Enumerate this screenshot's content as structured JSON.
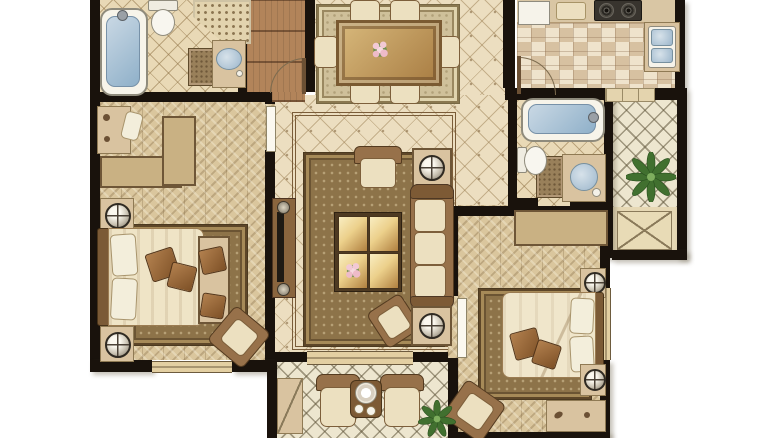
{
  "meta": {
    "kind": "residential-floor-plan-rendering",
    "visible_text": [],
    "width_px": 780,
    "height_px": 438
  },
  "palette": {
    "background": "#ffffff",
    "wall": "#19120c",
    "diamond_tile": "#ecdec0",
    "small_tile": "#e9d9b6",
    "lattice_tile": "#ede6cf",
    "herringbone_wood": "#dac69d",
    "checker_tile_a": "#d7c1a1",
    "checker_tile_b": "#efe3cc",
    "plank_wood": "#b2845a",
    "rug_brown": "#8d7349",
    "rug_light": "#cfc09a",
    "upholstery_brown": "#97714a",
    "upholstery_cream": "#ece0c0",
    "water_blue": "#9cb6cb",
    "gold_table": "#ecd08b",
    "plant_green": "#41702f"
  },
  "rooms": [
    {
      "id": "bathroom-1",
      "position": "top-left",
      "floor": "small-diamond-tile",
      "furniture": [
        "bathtub",
        "toilet",
        "washbasin-counter",
        "shower-mosaic-corner",
        "bath-mat"
      ]
    },
    {
      "id": "entry-hall",
      "position": "top-middle-left",
      "floor": "wood-planks",
      "furniture": [
        "entry-door-swing"
      ]
    },
    {
      "id": "dining-room",
      "position": "top-middle",
      "floor": "diamond-tile",
      "furniture": [
        "dining-table",
        "flower-centerpiece",
        "chair-x6",
        "area-rug"
      ]
    },
    {
      "id": "kitchen",
      "position": "top-right",
      "floor": "checker-tile",
      "furniture": [
        "refrigerator",
        "cutting-board",
        "two-burner-cooktop",
        "double-sink",
        "door-swing",
        "steps"
      ]
    },
    {
      "id": "living-room",
      "position": "center",
      "floor": "diamond-tile-with-border",
      "furniture": [
        "tv-console",
        "three-seat-sofa",
        "armchair-x2",
        "coffee-table-4-panel",
        "side-table-with-lamp-x2",
        "flower-bouquet",
        "area-rug"
      ]
    },
    {
      "id": "master-bedroom",
      "position": "left",
      "floor": "herringbone-wood",
      "furniture": [
        "double-bed",
        "pillows",
        "bed-bench",
        "nightstand-with-lamp-x2",
        "l-shaped-wardrobe",
        "desk",
        "desk-chair",
        "armchair",
        "area-rug"
      ]
    },
    {
      "id": "bathroom-2",
      "position": "right-middle",
      "floor": "small-diamond-tile",
      "furniture": [
        "bathtub",
        "toilet",
        "round-washbasin-counter",
        "bath-mat"
      ]
    },
    {
      "id": "utility-balcony",
      "position": "right",
      "floor": "lattice-tile",
      "furniture": [
        "potted-plant",
        "equipment-platform-x"
      ]
    },
    {
      "id": "bedroom-2",
      "position": "bottom-right",
      "floor": "herringbone-wood",
      "furniture": [
        "double-bed",
        "pillows",
        "wardrobe",
        "nightstand-with-lamp-x2",
        "desk",
        "armchair",
        "area-rug",
        "door-leaf"
      ]
    },
    {
      "id": "balcony",
      "position": "bottom-middle",
      "floor": "lattice-tile",
      "furniture": [
        "armchair-x2",
        "tea-table",
        "tea-set",
        "potted-plant",
        "storage-cabinet"
      ]
    }
  ],
  "openings": {
    "windows": [
      "master-bedroom-south",
      "living-room-south-slider",
      "bedroom-2-east"
    ],
    "doors": [
      "entry",
      "kitchen",
      "master-bedroom",
      "bathroom-2",
      "bedroom-2"
    ]
  }
}
